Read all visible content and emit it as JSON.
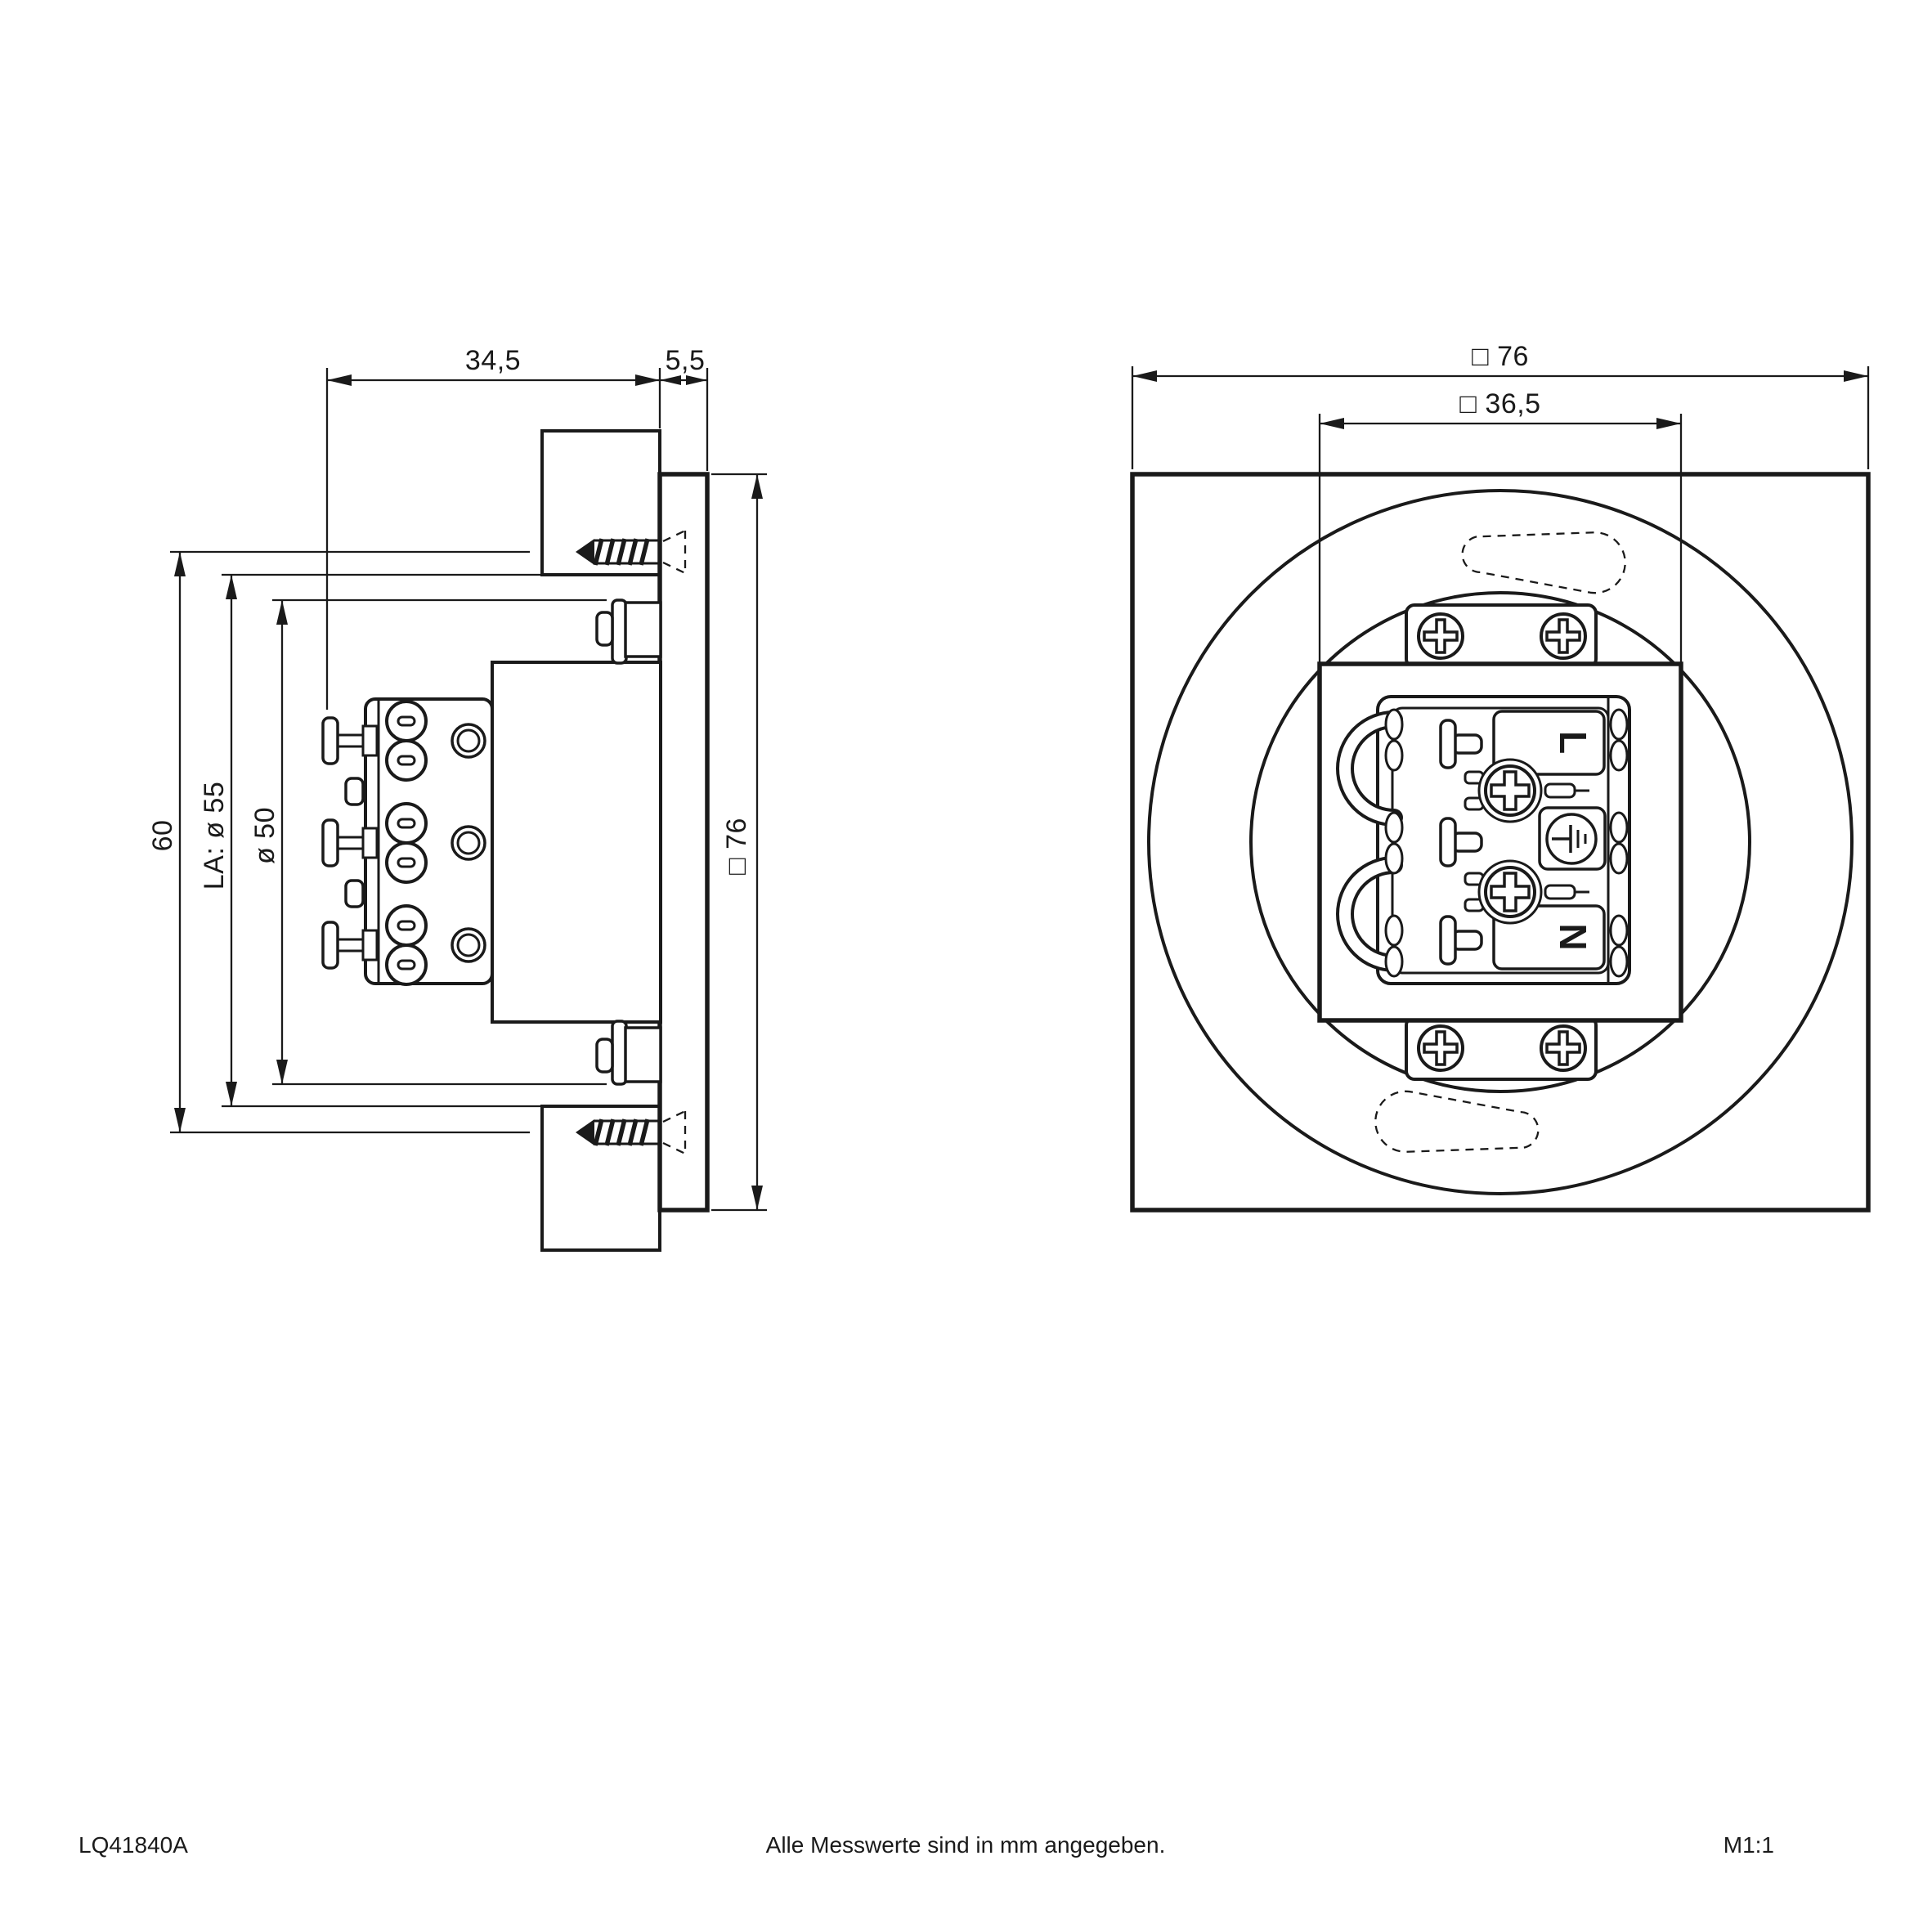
{
  "footer": {
    "drawing_number": "LQ41840A",
    "units_note": "Alle Messwerte sind in mm angegeben.",
    "scale": "M1:1"
  },
  "side_view": {
    "dim_recess_depth": "34,5",
    "dim_panel_thickness": "5,5",
    "dim_screw_spacing": "60",
    "dim_cutout_diameter": "LA: ø 55",
    "dim_body_diameter": "ø 50",
    "dim_plate_size": "□ 76"
  },
  "front_view": {
    "dim_outer_size": "□ 76",
    "dim_cutout_size": "□ 36,5",
    "terminal_live": "L",
    "terminal_neutral": "N"
  },
  "line_color": "#1a1a1a",
  "background_color": "#ffffff"
}
